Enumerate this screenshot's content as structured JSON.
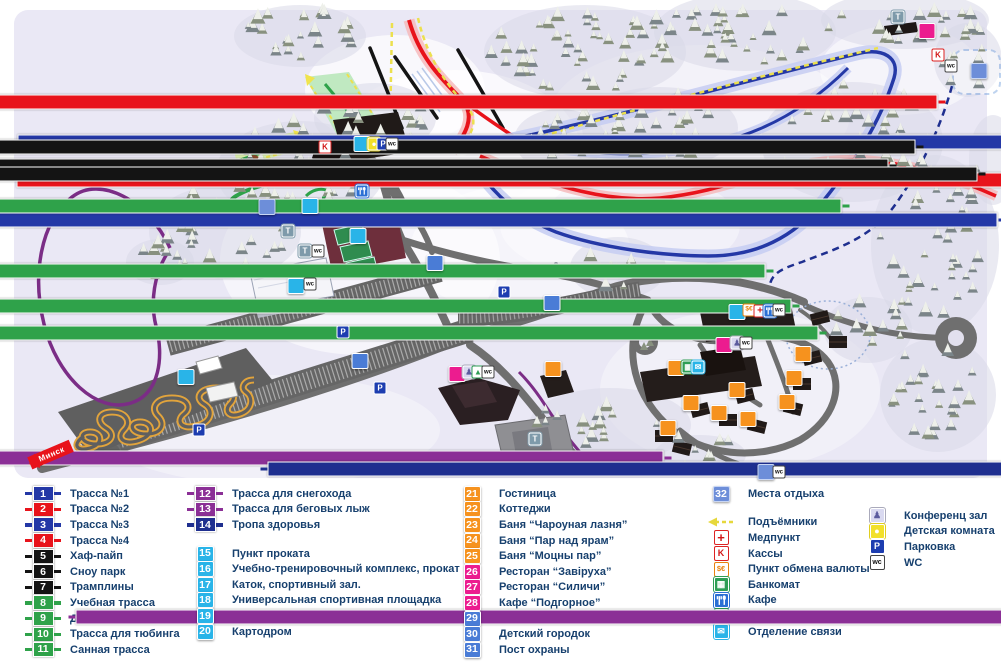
{
  "colors": {
    "blue": "#2438a6",
    "red": "#e8131b",
    "black": "#141414",
    "green": "#2fa24a",
    "purple": "#8b2f96",
    "navy": "#1f2f8f",
    "cyan": "#29b4e8",
    "orange": "#f6921e",
    "magenta": "#ec1c8f",
    "mblue": "#4a7cd6",
    "lblue": "#6d8ed9",
    "park": "#1d3db0",
    "text": "#17406e"
  },
  "map": {
    "minsk_label": "Минск",
    "markers": [
      {
        "t": "route",
        "n": "1",
        "c": "blue",
        "x": 518,
        "y": 142
      },
      {
        "t": "route",
        "n": "2",
        "c": "red",
        "x": 517,
        "y": 165
      },
      {
        "t": "route",
        "n": "3",
        "c": "blue",
        "x": 497,
        "y": 190
      },
      {
        "t": "route",
        "n": "4",
        "c": "red",
        "x": 437,
        "y": 57
      },
      {
        "t": "route",
        "n": "5",
        "c": "black",
        "x": 415,
        "y": 87
      },
      {
        "t": "route",
        "n": "6",
        "c": "black",
        "x": 388,
        "y": 91
      },
      {
        "t": "route",
        "n": "7",
        "c": "black",
        "x": 477,
        "y": 84
      },
      {
        "t": "route",
        "n": "8",
        "c": "green",
        "x": 341,
        "y": 101
      },
      {
        "t": "route",
        "n": "9",
        "c": "green",
        "x": 265,
        "y": 151
      },
      {
        "t": "route",
        "n": "10",
        "c": "green",
        "x": 291,
        "y": 171
      },
      {
        "t": "route",
        "n": "11",
        "c": "green",
        "x": 318,
        "y": 183
      },
      {
        "t": "route",
        "n": "12",
        "c": "purple",
        "x": 163,
        "y": 293
      },
      {
        "t": "route",
        "n": "13",
        "c": "purple",
        "x": 576,
        "y": 437
      },
      {
        "t": "route",
        "n": "14",
        "c": "navy",
        "x": 768,
        "y": 274
      },
      {
        "t": "sq",
        "n": "15",
        "c": "cyan",
        "x": 737,
        "y": 312
      },
      {
        "t": "sq",
        "n": "16",
        "c": "cyan",
        "x": 362,
        "y": 144
      },
      {
        "t": "sq",
        "n": "17",
        "c": "cyan",
        "x": 296,
        "y": 286
      },
      {
        "t": "sq",
        "n": "18",
        "c": "cyan",
        "x": 358,
        "y": 236
      },
      {
        "t": "sq",
        "n": "19",
        "c": "cyan",
        "x": 310,
        "y": 206
      },
      {
        "t": "sq",
        "n": "20",
        "c": "cyan",
        "x": 186,
        "y": 377
      },
      {
        "t": "sq",
        "n": "21",
        "c": "orange",
        "x": 676,
        "y": 368
      },
      {
        "t": "sq",
        "n": "22",
        "c": "orange",
        "x": 803,
        "y": 354
      },
      {
        "t": "sq",
        "n": "22",
        "c": "orange",
        "x": 794,
        "y": 378
      },
      {
        "t": "sq",
        "n": "22",
        "c": "orange",
        "x": 787,
        "y": 402
      },
      {
        "t": "sq",
        "n": "22",
        "c": "orange",
        "x": 691,
        "y": 403
      },
      {
        "t": "sq",
        "n": "22",
        "c": "orange",
        "x": 719,
        "y": 413
      },
      {
        "t": "sq",
        "n": "22",
        "c": "orange",
        "x": 748,
        "y": 419
      },
      {
        "t": "sq",
        "n": "23",
        "c": "orange",
        "x": 737,
        "y": 390
      },
      {
        "t": "sq",
        "n": "24",
        "c": "orange",
        "x": 668,
        "y": 428
      },
      {
        "t": "sq",
        "n": "25",
        "c": "orange",
        "x": 553,
        "y": 369
      },
      {
        "t": "sq",
        "n": "26",
        "c": "magenta",
        "x": 457,
        "y": 374
      },
      {
        "t": "sq",
        "n": "27",
        "c": "magenta",
        "x": 724,
        "y": 345
      },
      {
        "t": "sq",
        "n": "28",
        "c": "magenta",
        "x": 927,
        "y": 31
      },
      {
        "t": "sq",
        "n": "29",
        "c": "mblue",
        "x": 360,
        "y": 361
      },
      {
        "t": "sq",
        "n": "30",
        "c": "mblue",
        "x": 435,
        "y": 263
      },
      {
        "t": "sq",
        "n": "31",
        "c": "mblue",
        "x": 552,
        "y": 303
      },
      {
        "t": "sq",
        "n": "32",
        "c": "lblue",
        "x": 267,
        "y": 207
      },
      {
        "t": "sq",
        "n": "32",
        "c": "lblue",
        "x": 979,
        "y": 71
      },
      {
        "t": "sq",
        "n": "32",
        "c": "lblue",
        "x": 766,
        "y": 472
      },
      {
        "t": "icon",
        "k": "park",
        "x": 343,
        "y": 332
      },
      {
        "t": "icon",
        "k": "park",
        "x": 504,
        "y": 292
      },
      {
        "t": "icon",
        "k": "park",
        "x": 380,
        "y": 388
      },
      {
        "t": "icon",
        "k": "park",
        "x": 199,
        "y": 430
      },
      {
        "t": "icon",
        "k": "kassa",
        "x": 325,
        "y": 147
      },
      {
        "t": "icon",
        "k": "kassa",
        "x": 938,
        "y": 55
      },
      {
        "t": "icon",
        "k": "t",
        "x": 288,
        "y": 231
      },
      {
        "t": "icon",
        "k": "t",
        "x": 305,
        "y": 251
      },
      {
        "t": "icon",
        "k": "wc",
        "x": 318,
        "y": 251
      },
      {
        "t": "icon",
        "k": "wc",
        "x": 310,
        "y": 284
      },
      {
        "t": "icon",
        "k": "t",
        "x": 535,
        "y": 439
      },
      {
        "t": "icon",
        "k": "t",
        "x": 898,
        "y": 17
      },
      {
        "t": "icon",
        "k": "wc",
        "x": 951,
        "y": 66
      },
      {
        "t": "icon",
        "k": "wc",
        "x": 779,
        "y": 472
      },
      {
        "t": "icon",
        "k": "kids",
        "x": 374,
        "y": 144
      },
      {
        "t": "icon",
        "k": "park",
        "x": 383,
        "y": 144
      },
      {
        "t": "icon",
        "k": "wc",
        "x": 392,
        "y": 144
      },
      {
        "t": "icon",
        "k": "exch",
        "x": 749,
        "y": 310
      },
      {
        "t": "icon",
        "k": "med",
        "x": 760,
        "y": 311
      },
      {
        "t": "icon",
        "k": "cafe",
        "x": 770,
        "y": 311
      },
      {
        "t": "icon",
        "k": "wc",
        "x": 779,
        "y": 310
      },
      {
        "t": "icon",
        "k": "conf",
        "x": 737,
        "y": 343
      },
      {
        "t": "icon",
        "k": "wc",
        "x": 746,
        "y": 343
      },
      {
        "t": "icon",
        "k": "bank",
        "x": 688,
        "y": 367
      },
      {
        "t": "icon",
        "k": "post",
        "x": 698,
        "y": 367
      },
      {
        "t": "icon",
        "k": "conf",
        "x": 469,
        "y": 372
      },
      {
        "t": "icon",
        "k": "bil",
        "x": 478,
        "y": 372
      },
      {
        "t": "icon",
        "k": "wc",
        "x": 488,
        "y": 372
      },
      {
        "t": "icon",
        "k": "cafe",
        "x": 362,
        "y": 191
      }
    ]
  },
  "legend": {
    "col1": [
      {
        "n": "1",
        "c": "blue",
        "label": "Трасса №1"
      },
      {
        "n": "2",
        "c": "red",
        "label": "Трасса №2"
      },
      {
        "n": "3",
        "c": "blue",
        "label": "Трасса №3"
      },
      {
        "n": "4",
        "c": "red",
        "label": "Трасса №4"
      },
      {
        "n": "5",
        "c": "black",
        "label": "Хаф-пайп"
      },
      {
        "n": "6",
        "c": "black",
        "label": "Сноу парк"
      },
      {
        "n": "7",
        "c": "black",
        "label": "Трамплины"
      },
      {
        "n": "8",
        "c": "green",
        "label": "Учебная трасса"
      },
      {
        "n": "9",
        "c": "green",
        "label": "Детская трасса"
      },
      {
        "n": "10",
        "c": "green",
        "label": "Трасса для тюбинга"
      },
      {
        "n": "11",
        "c": "green",
        "label": "Санная трасса"
      }
    ],
    "col2a": [
      {
        "n": "12",
        "c": "purple",
        "label": "Трасса для снегохода"
      },
      {
        "n": "13",
        "c": "purple",
        "label": "Трасса для беговых лыж"
      },
      {
        "n": "14",
        "c": "navy",
        "label": "Тропа здоровья"
      }
    ],
    "col2b": [
      {
        "n": "15",
        "c": "cyan",
        "label": "Пункт проката"
      },
      {
        "n": "16",
        "c": "cyan",
        "label": "Учебно-тренировочный комплекс, прокат"
      },
      {
        "n": "17",
        "c": "cyan",
        "label": "Каток, спортивный зал."
      },
      {
        "n": "18",
        "c": "cyan",
        "label": "Универсальная спортивная площадка"
      },
      {
        "n": "19",
        "c": "cyan",
        "label": "Пейнтбольный клуб “Тактика”"
      },
      {
        "n": "20",
        "c": "cyan",
        "label": "Картодром"
      }
    ],
    "col3": [
      {
        "n": "21",
        "c": "orange",
        "label": "Гостиница"
      },
      {
        "n": "22",
        "c": "orange",
        "label": "Коттеджи"
      },
      {
        "n": "23",
        "c": "orange",
        "label": "Баня “Чароуная лазня”"
      },
      {
        "n": "24",
        "c": "orange",
        "label": "Баня “Пар над ярам”"
      },
      {
        "n": "25",
        "c": "orange",
        "label": "Баня “Моцны пар”"
      },
      {
        "n": "26",
        "c": "magenta",
        "label": "Ресторан “Завіруха”"
      },
      {
        "n": "27",
        "c": "magenta",
        "label": "Ресторан “Силичи”"
      },
      {
        "n": "28",
        "c": "magenta",
        "label": "Кафе “Подгорное”"
      },
      {
        "n": "29",
        "c": "mblue",
        "label": "Остановка общественного транспорта"
      },
      {
        "n": "30",
        "c": "mblue",
        "label": "Детский городок"
      },
      {
        "n": "31",
        "c": "mblue",
        "label": "Пост охраны"
      }
    ],
    "col4a": [
      {
        "n": "32",
        "c": "lblue",
        "label": "Места отдыха"
      }
    ],
    "col4b": [
      {
        "k": "lift",
        "label": "Подъёмники"
      },
      {
        "k": "med",
        "label": "Медпункт"
      },
      {
        "k": "kassa",
        "label": "Кассы"
      },
      {
        "k": "exch",
        "label": "Пункт обмена валюты"
      },
      {
        "k": "bank",
        "label": "Банкомат"
      },
      {
        "k": "cafe",
        "label": "Кафе"
      },
      {
        "k": "bil",
        "label": "Бильярд"
      },
      {
        "k": "post",
        "label": "Отделение связи"
      }
    ],
    "col4c": [
      {
        "k": "conf",
        "label": "Конференц зал"
      },
      {
        "k": "kids",
        "label": "Детская комната"
      },
      {
        "k": "park",
        "label": "Парковка"
      },
      {
        "k": "wc",
        "label": "WC"
      }
    ]
  }
}
